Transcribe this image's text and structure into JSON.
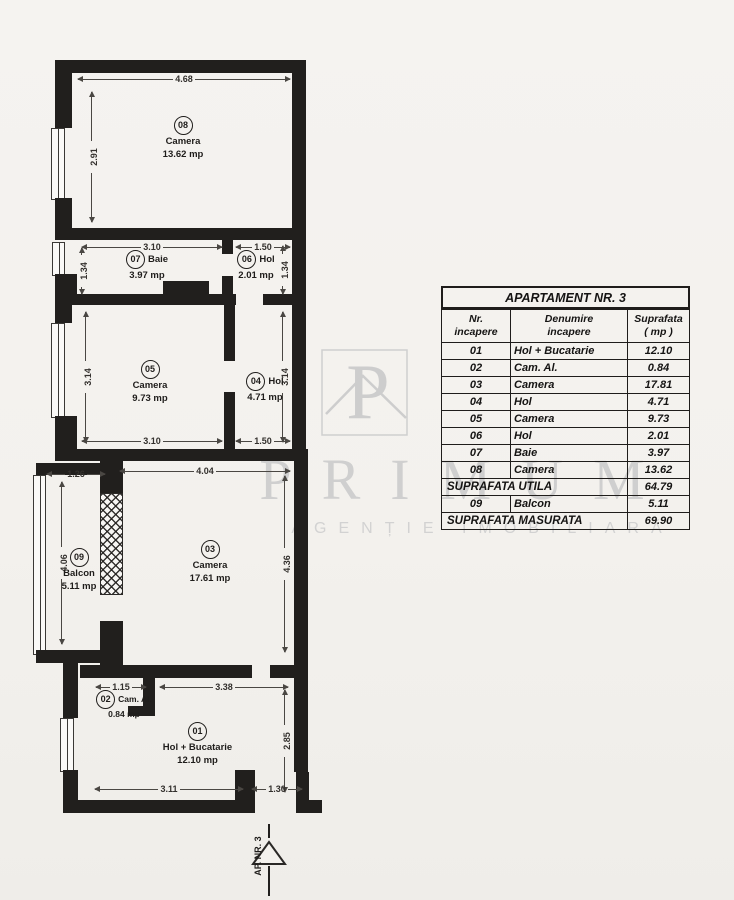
{
  "watermark": {
    "monogram": "P",
    "brand": "PRIMUM",
    "tagline": "AGENȚIE IMOBILIARĂ"
  },
  "entrance": {
    "label": "AP. NR. 3"
  },
  "plan": {
    "rooms": {
      "r01": {
        "num": "01",
        "name": "Hol + Bucatarie",
        "area": "12.10 mp"
      },
      "r02": {
        "num": "02",
        "name": "Cam. Al.",
        "area": "0.84 mp"
      },
      "r03": {
        "num": "03",
        "name": "Camera",
        "area": "17.61 mp"
      },
      "r04": {
        "num": "04",
        "name": "Hol",
        "area": "4.71 mp"
      },
      "r05": {
        "num": "05",
        "name": "Camera",
        "area": "9.73 mp"
      },
      "r06": {
        "num": "06",
        "name": "Hol",
        "area": "2.01 mp"
      },
      "r07": {
        "num": "07",
        "name": "Baie",
        "area": "3.97 mp"
      },
      "r08": {
        "num": "08",
        "name": "Camera",
        "area": "13.62 mp"
      },
      "r09": {
        "num": "09",
        "name": "Balcon",
        "area": "5.11 mp"
      }
    },
    "dims": {
      "room08_width": "4.68",
      "room08_height": "2.91",
      "room07_width": "3.10",
      "room06_width": "1.50",
      "room07_height": "1.34",
      "room06_height": "1.34",
      "room05_height": "3.14",
      "room04_height": "3.14",
      "room05_width": "3.10",
      "room04_width": "1.50",
      "room03_width": "4.04",
      "balcony_width": "1.26",
      "balcony_height": "4.06",
      "room03_height": "4.36",
      "room02_width": "1.15",
      "room01_top_width": "3.38",
      "room01_height": "2.85",
      "room01_bottom_width": "3.11",
      "entrance_width": "1.30"
    }
  },
  "table": {
    "title": "APARTAMENT NR. 3",
    "col1_header": [
      "Nr.",
      "incapere"
    ],
    "col2_header": [
      "Denumire",
      "incapere"
    ],
    "col3_header": [
      "Suprafata",
      "( mp )"
    ],
    "rows": [
      [
        "01",
        "Hol + Bucatarie",
        "12.10"
      ],
      [
        "02",
        "Cam. Al.",
        "0.84"
      ],
      [
        "03",
        "Camera",
        "17.81"
      ],
      [
        "04",
        "Hol",
        "4.71"
      ],
      [
        "05",
        "Camera",
        "9.73"
      ],
      [
        "06",
        "Hol",
        "2.01"
      ],
      [
        "07",
        "Baie",
        "3.97"
      ],
      [
        "08",
        "Camera",
        "13.62"
      ]
    ],
    "subtotal_label": "SUPRAFATA UTILA",
    "subtotal_value": "64.79",
    "balcony_row": [
      "09",
      "Balcon",
      "5.11"
    ],
    "total_label": "SUPRAFATA MASURATA",
    "total_value": "69.90"
  }
}
